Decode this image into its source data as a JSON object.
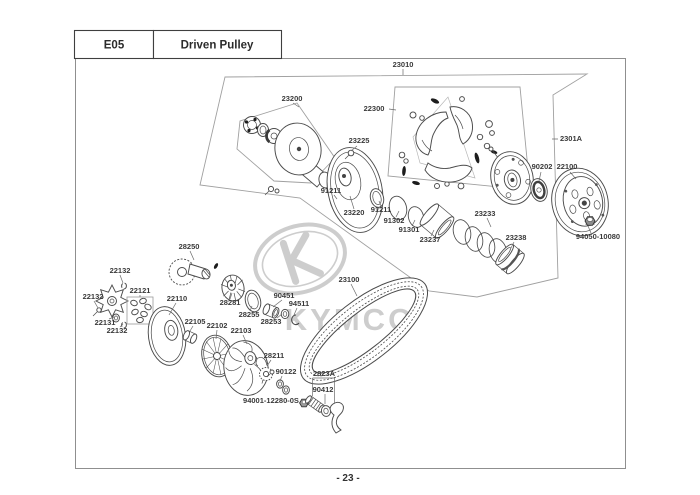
{
  "header": {
    "section_code": "E05",
    "section_title": "Driven Pulley"
  },
  "footer": {
    "page_label": "- 23 -"
  },
  "watermark": {
    "brand": "KYMCO"
  },
  "colors": {
    "line": "#4b4b4b",
    "boundary": "#a0a0a0",
    "label_text": "#3a3a3a",
    "watermark": "#cdcdcd",
    "page_border": "#8f8f8f"
  },
  "diagram": {
    "labels": [
      {
        "part": "23010",
        "x": 403,
        "y": 67
      },
      {
        "part": "23200",
        "x": 292,
        "y": 101
      },
      {
        "part": "22300",
        "x": 374,
        "y": 111
      },
      {
        "part": "23225",
        "x": 359,
        "y": 143
      },
      {
        "part": "2301A",
        "x": 571,
        "y": 141
      },
      {
        "part": "90202",
        "x": 542,
        "y": 169
      },
      {
        "part": "22100",
        "x": 567,
        "y": 169
      },
      {
        "part": "91211",
        "x": 331,
        "y": 193
      },
      {
        "part": "23220",
        "x": 354,
        "y": 215
      },
      {
        "part": "91211",
        "x": 381,
        "y": 212
      },
      {
        "part": "91302",
        "x": 394,
        "y": 223
      },
      {
        "part": "91301",
        "x": 409,
        "y": 232
      },
      {
        "part": "23237",
        "x": 430,
        "y": 242
      },
      {
        "part": "23233",
        "x": 485,
        "y": 216
      },
      {
        "part": "23238",
        "x": 516,
        "y": 240
      },
      {
        "part": "94050-10080",
        "x": 598,
        "y": 239
      },
      {
        "part": "23100",
        "x": 349,
        "y": 282
      },
      {
        "part": "28250",
        "x": 189,
        "y": 249
      },
      {
        "part": "22132",
        "x": 120,
        "y": 273
      },
      {
        "part": "22132",
        "x": 93,
        "y": 299
      },
      {
        "part": "22121",
        "x": 140,
        "y": 293
      },
      {
        "part": "22110",
        "x": 177,
        "y": 301
      },
      {
        "part": "28281",
        "x": 230,
        "y": 305
      },
      {
        "part": "90451",
        "x": 284,
        "y": 298
      },
      {
        "part": "94511",
        "x": 299,
        "y": 306
      },
      {
        "part": "28255",
        "x": 249,
        "y": 317
      },
      {
        "part": "28253",
        "x": 271,
        "y": 324
      },
      {
        "part": "22131",
        "x": 105,
        "y": 325
      },
      {
        "part": "22132",
        "x": 117,
        "y": 333
      },
      {
        "part": "22105",
        "x": 195,
        "y": 324
      },
      {
        "part": "22102",
        "x": 217,
        "y": 328
      },
      {
        "part": "22103",
        "x": 241,
        "y": 333
      },
      {
        "part": "28211",
        "x": 274,
        "y": 358
      },
      {
        "part": "90122",
        "x": 286,
        "y": 374
      },
      {
        "part": "2823A",
        "x": 324,
        "y": 376
      },
      {
        "part": "90412",
        "x": 323,
        "y": 392
      },
      {
        "part": "94001-12280-0S",
        "x": 271,
        "y": 403
      }
    ]
  }
}
